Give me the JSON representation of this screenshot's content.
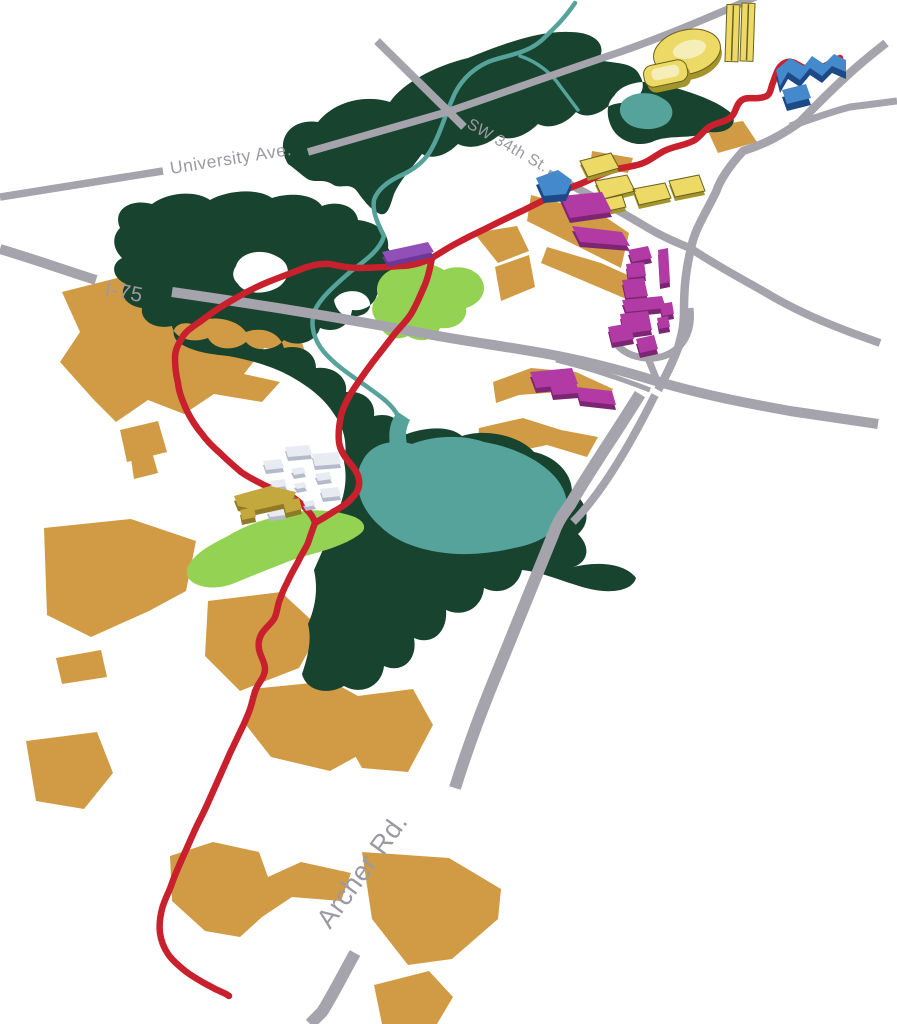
{
  "map": {
    "title": "Isometric route map of SW Gainesville (University of Florida area)",
    "road_labels": {
      "university_ave": "University Ave.",
      "sw_34th_st": "SW 34th St.",
      "i_75": "I-75",
      "archer_rd": "Archer Rd."
    },
    "colors": {
      "background": "#ffffff",
      "road": "#a5a3ab",
      "road_label": "#9b99a1",
      "route": "#c8202c",
      "forest": "#17432f",
      "water": "#55a39b",
      "parcel": "#d09b44",
      "park": "#94d254",
      "yellow_top": "#ecd966",
      "yellow_side": "#a3942c",
      "yellow_inner": "#f5eeb9",
      "magenta_top": "#b13aa4",
      "magenta_side": "#7c2573",
      "blue_top": "#4489cc",
      "blue_side": "#1d4a87",
      "white_top": "#e8ebf2",
      "white_side": "#b4bac9",
      "olive_top": "#c3a83e",
      "olive_side": "#8f7a26",
      "purple_top": "#9150b8",
      "purple_side": "#6f3795"
    }
  }
}
